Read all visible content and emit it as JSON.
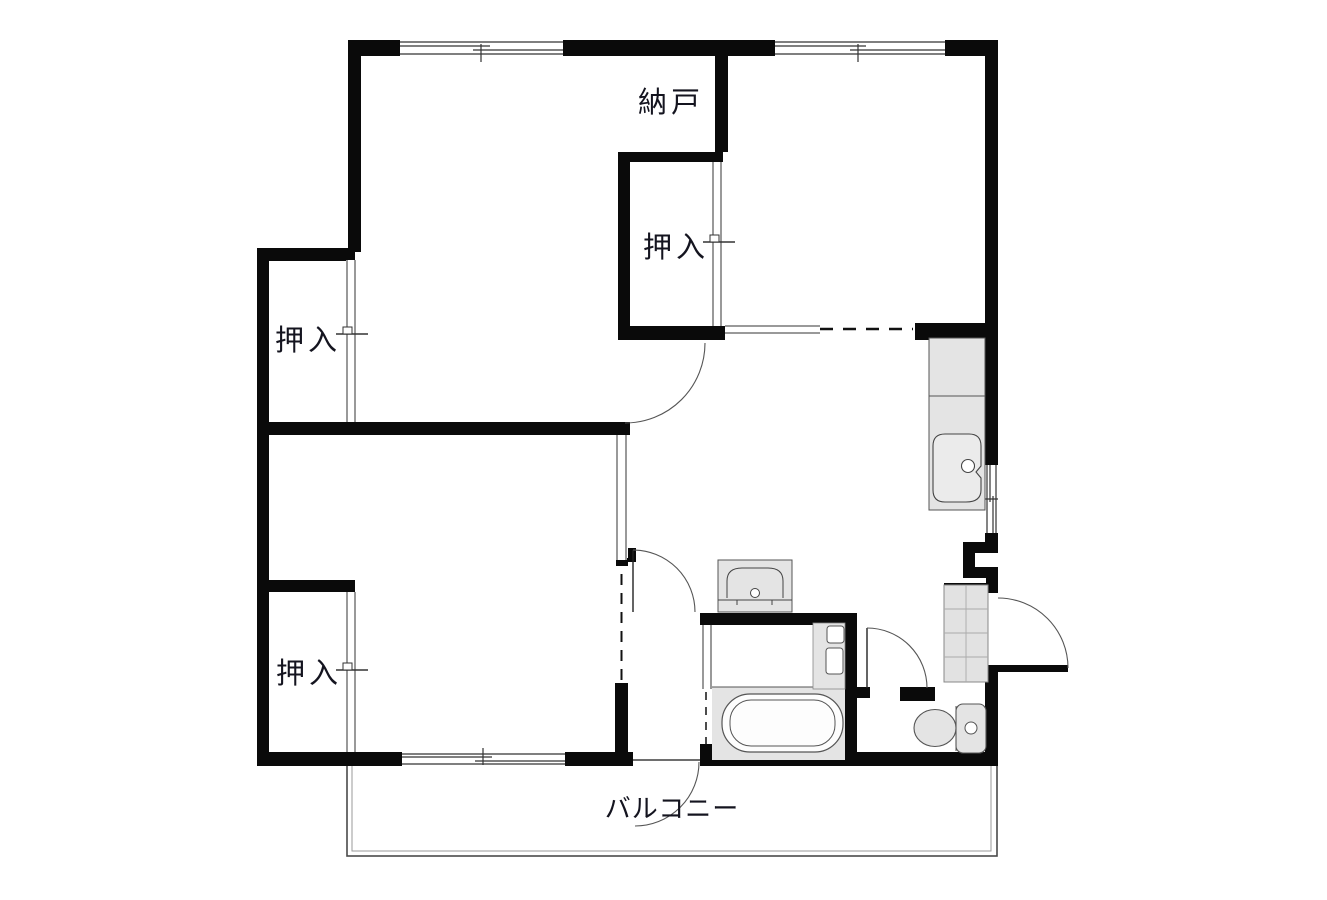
{
  "page": {
    "type": "floor-plan-drawing",
    "background": "#ffffff"
  },
  "colors": {
    "wall": "#0a0a0a",
    "thin_line": "#444444",
    "fixture_fill": "#e4e4e4",
    "fixture_stroke": "#555555",
    "label_text": "#14141f"
  },
  "labels": {
    "storage": "納戸",
    "closet_upper": "押入",
    "closet_left": "押入",
    "closet_lower": "押入",
    "balcony": "バルコニー"
  },
  "fixtures": [
    "kitchen-counter-with-sink",
    "wash-basin",
    "bathtub",
    "water-heater",
    "toilet",
    "shoe-cabinet"
  ],
  "openings": {
    "hinged_doors": 5,
    "sliding_doors": 6,
    "windows": 4
  }
}
